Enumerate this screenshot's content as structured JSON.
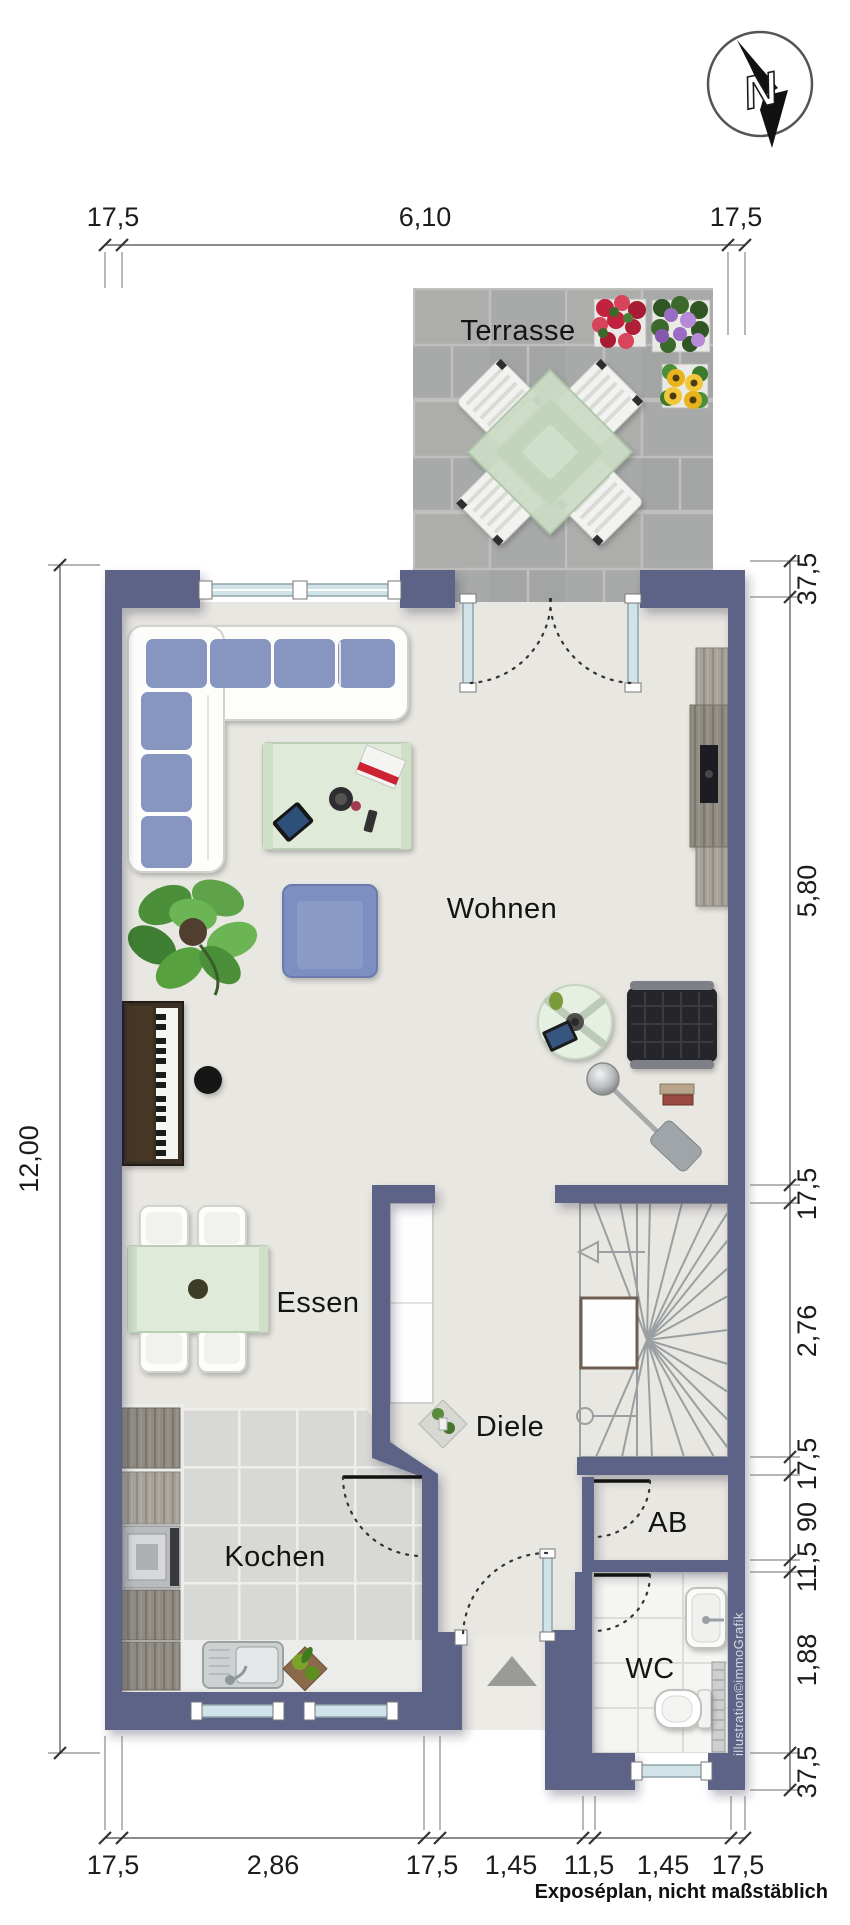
{
  "plan": {
    "rooms": {
      "terrace": "Terrasse",
      "living": "Wohnen",
      "dining": "Essen",
      "hall": "Diele",
      "kitchen": "Kochen",
      "storage": "AB",
      "wc": "WC"
    },
    "dimensions": {
      "top": [
        "17,5",
        "6,10",
        "17,5"
      ],
      "bottom": [
        "17,5",
        "2,86",
        "17,5",
        "1,45",
        "11,5",
        "1,45",
        "17,5"
      ],
      "left": [
        "12,00"
      ],
      "right": [
        "37,5",
        "5,80",
        "17,5",
        "2,76",
        "17,5",
        "90",
        "11,5",
        "1,88",
        "37,5"
      ]
    },
    "compass": {
      "label": "N"
    },
    "footer": {
      "note": "Exposéplan, nicht maßstäblich",
      "credit": "illustration©immoGrafik"
    },
    "colors": {
      "wall": "#5b6386",
      "floor": "#e9e7e1",
      "terrace": "#a8a9a9",
      "kitchenTile": "#d8d8d5",
      "wcTile": "#f5f5f2",
      "glass": "#cfe3e8",
      "cushion": "#8796c1",
      "tableGreen": "#dfead9"
    }
  }
}
